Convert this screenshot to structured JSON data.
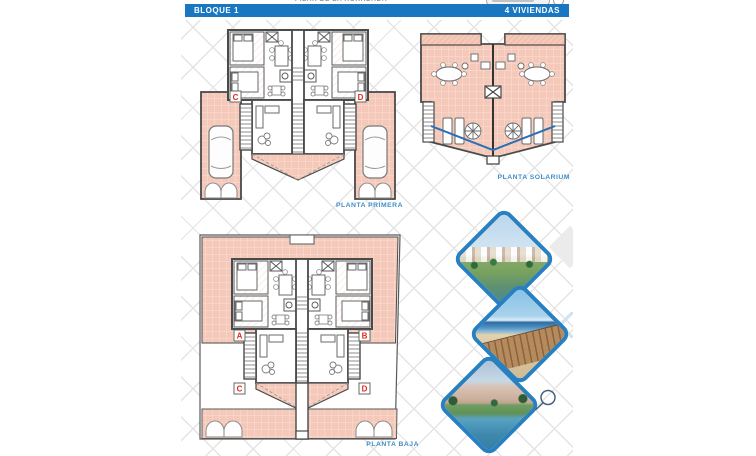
{
  "top_strip": {
    "location_text": "PILAR DE LA HORADADA"
  },
  "header": {
    "left_label": "BLOQUE 1",
    "right_label": "4 VIVIENDAS"
  },
  "plans": {
    "primera": {
      "label": "PLANTA PRIMERA",
      "unit_c": "C",
      "unit_d": "D"
    },
    "solarium": {
      "label": "PLANTA SOLARIUM"
    },
    "baja": {
      "label": "PLANTA BAJA",
      "unit_a": "A",
      "unit_b": "B",
      "unit_c": "C",
      "unit_d": "D"
    }
  },
  "photos": [
    {
      "name": "residence-render"
    },
    {
      "name": "beach-boardwalk"
    },
    {
      "name": "pool-garden"
    }
  ],
  "colors": {
    "header_bg": "#1877c0",
    "plan_label_blue": "#3f8ec8",
    "unit_letter_red": "#e02a1e",
    "terrace_pink": "#f5c9b9",
    "terrace_grid": "#fbe0d6",
    "wall": "#4a4a4a",
    "diamond_border": "#2980c0",
    "balustrade_blue": "#2a6fb5",
    "lattice_gray": "#e4e4e4"
  }
}
